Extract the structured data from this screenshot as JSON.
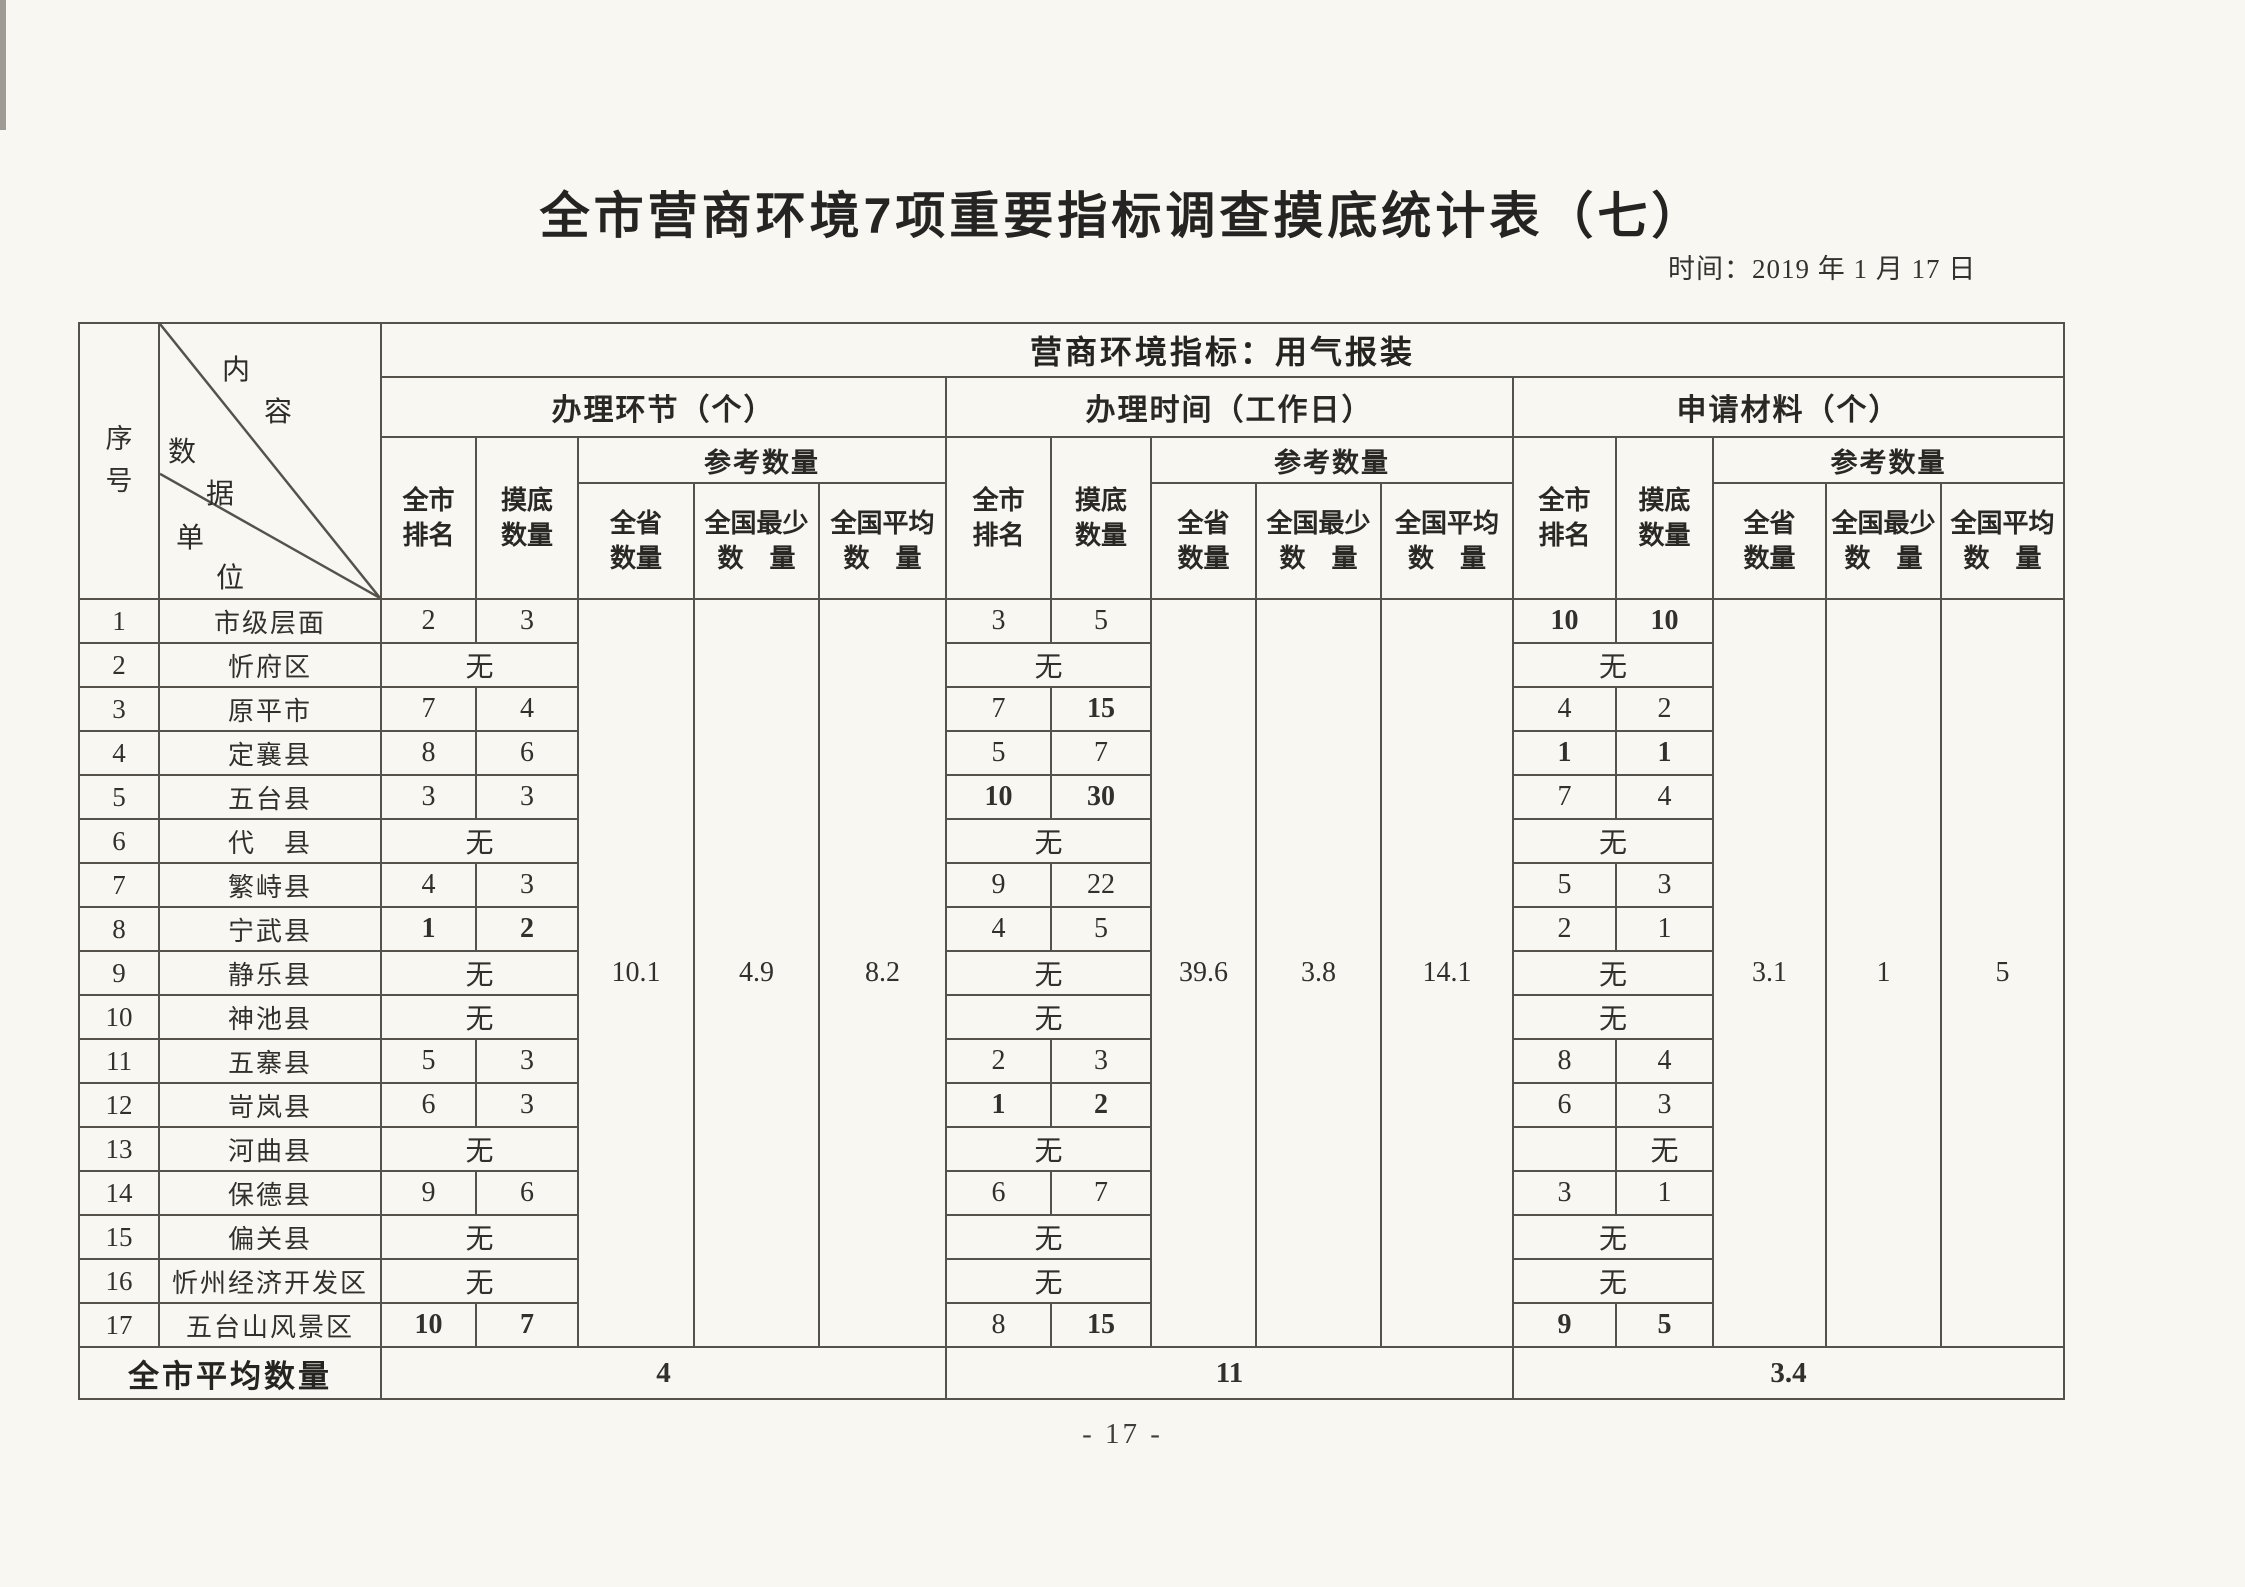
{
  "page": {
    "title": "全市营商环境7项重要指标调查摸底统计表（七）",
    "date": "时间：2019 年 1 月 17 日",
    "page_number": "- 17 -"
  },
  "header": {
    "serial": "序\n号",
    "corner_chars": [
      "内",
      "容",
      "数",
      "据",
      "单",
      "位"
    ],
    "indicator_title": "营商环境指标：用气报装",
    "groups": [
      "办理环节（个）",
      "办理时间（工作日）",
      "申请材料（个）"
    ],
    "rank": "全市\n排名",
    "survey": "摸底\n数量",
    "reference": "参考数量",
    "province": "全省\n数量",
    "national_min": "全国最少\n数　量",
    "national_avg": "全国平均\n数　量"
  },
  "reference_values": {
    "g1": {
      "province": "10.1",
      "national_min": "4.9",
      "national_avg": "8.2"
    },
    "g2": {
      "province": "39.6",
      "national_min": "3.8",
      "national_avg": "14.1"
    },
    "g3": {
      "province": "3.1",
      "national_min": "1",
      "national_avg": "5"
    }
  },
  "rows": [
    {
      "no": "1",
      "unit": "市级层面",
      "g1": {
        "rank": "2",
        "amount": "3"
      },
      "g2": {
        "rank": "3",
        "amount": "5"
      },
      "g3": {
        "rank": "10",
        "amount": "10"
      }
    },
    {
      "no": "2",
      "unit": "忻府区",
      "g1": {
        "merged": "无"
      },
      "g2": {
        "merged": "无"
      },
      "g3": {
        "merged": "无"
      }
    },
    {
      "no": "3",
      "unit": "原平市",
      "g1": {
        "rank": "7",
        "amount": "4"
      },
      "g2": {
        "rank": "7",
        "amount": "15"
      },
      "g3": {
        "rank": "4",
        "amount": "2"
      }
    },
    {
      "no": "4",
      "unit": "定襄县",
      "g1": {
        "rank": "8",
        "amount": "6"
      },
      "g2": {
        "rank": "5",
        "amount": "7"
      },
      "g3": {
        "rank": "1",
        "amount": "1"
      }
    },
    {
      "no": "5",
      "unit": "五台县",
      "g1": {
        "rank": "3",
        "amount": "3"
      },
      "g2": {
        "rank": "10",
        "amount": "30"
      },
      "g3": {
        "rank": "7",
        "amount": "4"
      }
    },
    {
      "no": "6",
      "unit": "代　县",
      "g1": {
        "merged": "无"
      },
      "g2": {
        "merged": "无"
      },
      "g3": {
        "merged": "无"
      }
    },
    {
      "no": "7",
      "unit": "繁峙县",
      "g1": {
        "rank": "4",
        "amount": "3"
      },
      "g2": {
        "rank": "9",
        "amount": "22"
      },
      "g3": {
        "rank": "5",
        "amount": "3"
      }
    },
    {
      "no": "8",
      "unit": "宁武县",
      "g1": {
        "rank": "1",
        "amount": "2"
      },
      "g2": {
        "rank": "4",
        "amount": "5"
      },
      "g3": {
        "rank": "2",
        "amount": "1"
      }
    },
    {
      "no": "9",
      "unit": "静乐县",
      "g1": {
        "merged": "无"
      },
      "g2": {
        "merged": "无"
      },
      "g3": {
        "merged": "无"
      }
    },
    {
      "no": "10",
      "unit": "神池县",
      "g1": {
        "merged": "无"
      },
      "g2": {
        "merged": "无"
      },
      "g3": {
        "merged": "无"
      }
    },
    {
      "no": "11",
      "unit": "五寨县",
      "g1": {
        "rank": "5",
        "amount": "3"
      },
      "g2": {
        "rank": "2",
        "amount": "3"
      },
      "g3": {
        "rank": "8",
        "amount": "4"
      }
    },
    {
      "no": "12",
      "unit": "岢岚县",
      "g1": {
        "rank": "6",
        "amount": "3"
      },
      "g2": {
        "rank": "1",
        "amount": "2"
      },
      "g3": {
        "rank": "6",
        "amount": "3"
      }
    },
    {
      "no": "13",
      "unit": "河曲县",
      "g1": {
        "merged": "无"
      },
      "g2": {
        "merged": "无"
      },
      "g3": {
        "rank": "",
        "amount": "无"
      }
    },
    {
      "no": "14",
      "unit": "保德县",
      "g1": {
        "rank": "9",
        "amount": "6"
      },
      "g2": {
        "rank": "6",
        "amount": "7"
      },
      "g3": {
        "rank": "3",
        "amount": "1"
      }
    },
    {
      "no": "15",
      "unit": "偏关县",
      "g1": {
        "merged": "无"
      },
      "g2": {
        "merged": "无"
      },
      "g3": {
        "merged": "无"
      }
    },
    {
      "no": "16",
      "unit": "忻州经济开发区",
      "g1": {
        "merged": "无"
      },
      "g2": {
        "merged": "无"
      },
      "g3": {
        "merged": "无"
      }
    },
    {
      "no": "17",
      "unit": "五台山风景区",
      "g1": {
        "rank": "10",
        "amount": "7"
      },
      "g2": {
        "rank": "8",
        "amount": "15"
      },
      "g3": {
        "rank": "9",
        "amount": "5"
      }
    }
  ],
  "footer": {
    "label": "全市平均数量",
    "g1": "4",
    "g2": "11",
    "g3": "3.4"
  }
}
